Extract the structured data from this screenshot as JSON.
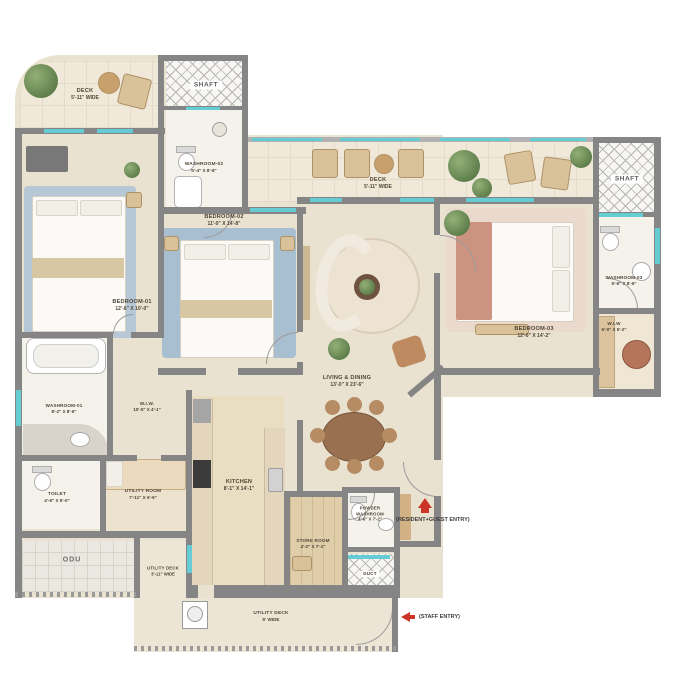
{
  "title": "Apartment Floor Plan",
  "rooms": {
    "deck1": {
      "name": "DECK",
      "dims": "5'-11\" WIDE"
    },
    "shaft1": {
      "name": "SHAFT"
    },
    "washroom2": {
      "name": "WASHROOM-02",
      "dims": "5'-4\" X 8'-8\""
    },
    "bedroom1": {
      "name": "BEDROOM-01",
      "dims": "12'-6\" X 10'-0\""
    },
    "bedroom2": {
      "name": "BEDROOM-02",
      "dims": "11'-0\" X 14'-8\""
    },
    "deck2": {
      "name": "DECK",
      "dims": "5'-11\" WIDE"
    },
    "living": {
      "name": "LIVING & DINING",
      "dims": "13'-0\" X 23'-6\""
    },
    "bedroom3": {
      "name": "BEDROOM-03",
      "dims": "12'-0\" X 14'-2\""
    },
    "shaft2": {
      "name": "SHAFT"
    },
    "washroom3": {
      "name": "WASHROOM-03",
      "dims": "5'-6\" X 8'-6\""
    },
    "wiw2": {
      "name": "W.I.W",
      "dims": "6'-0\" X 5'-2\""
    },
    "washroom1": {
      "name": "WASHROOM-01",
      "dims": "8'-2\" X 8'-6\""
    },
    "wiw1": {
      "name": "W.I.W.",
      "dims": "10'-5\" X 4'-1\""
    },
    "toilet": {
      "name": "TOILET",
      "dims": "4'-6\" X 5'-0\""
    },
    "utility": {
      "name": "UTILITY ROOM",
      "dims": "7'-11\" X 6'-6\""
    },
    "kitchen": {
      "name": "KITCHEN",
      "dims": "8'-1\" X 14'-1\""
    },
    "store": {
      "name": "STORE ROOM",
      "dims": "4'-2\" X 7'-1\""
    },
    "powder": {
      "name": "POWDER WASHROOM",
      "dims": "4'-6\" X 7'-2\""
    },
    "duct": {
      "name": "DUCT"
    },
    "odu": {
      "name": "ODU"
    },
    "utilitydeck1": {
      "name": "UTILITY DECK",
      "dims": "3'-11\" WIDE"
    },
    "utilitydeck2": {
      "name": "UTILITY DECK",
      "dims": "5' WIDE"
    }
  },
  "entries": {
    "resident": "(RESIDENT+GUEST ENTRY)",
    "staff": "(STAFF ENTRY)"
  },
  "colors": {
    "wall": "#858585",
    "window": "#66ccd3",
    "entry_arrow": "#cc3527",
    "floor": "#eae2d1"
  }
}
